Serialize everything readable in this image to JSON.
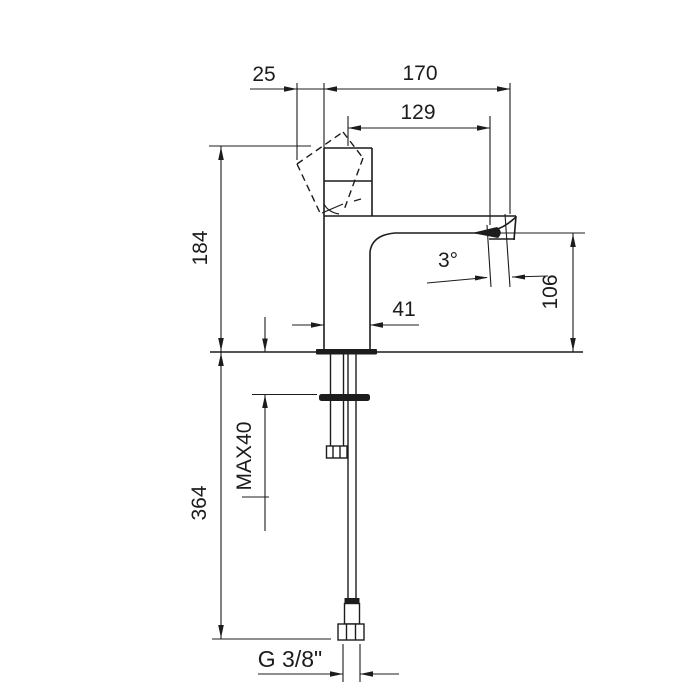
{
  "drawing": {
    "type": "technical-dimension-drawing",
    "subject": "single-lever basin mixer faucet, side elevation",
    "colors": {
      "line": "#1c1c1c",
      "background": "#ffffff"
    },
    "dimensions": {
      "handle_overhang": "25",
      "total_reach": "170",
      "spout_reach": "129",
      "height_to_handle_top": "184",
      "spout_end_angle": "3°",
      "spout_height": "106",
      "body_width": "41",
      "max_mounting_thickness": "MAX40",
      "hose_length_below_deck": "364",
      "thread_size": "G 3/8\""
    }
  }
}
